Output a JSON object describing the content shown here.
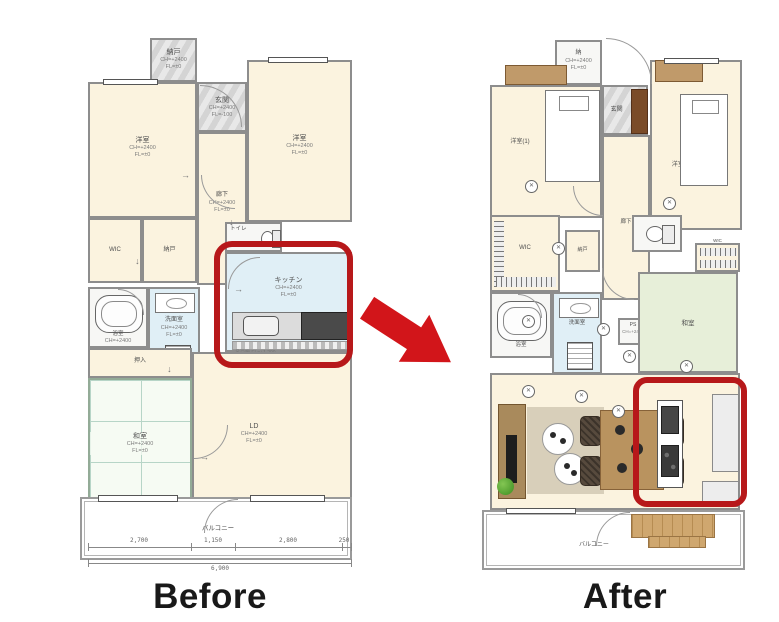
{
  "captions": {
    "before": "Before",
    "after": "After"
  },
  "icons": {
    "lamp_cross": "✕",
    "door_arrow": "→"
  },
  "colors": {
    "highlight_red": "#b7181a",
    "arrow_red": "#d2151a",
    "wall_gray": "#8d8d8d",
    "room_cream": "#fbf3df",
    "water_blue": "#e0eff6",
    "tatami_green": "#e7efd9",
    "wood_tan": "#b9935f",
    "closet_brown": "#7a4b28"
  },
  "before": {
    "rooms": {
      "storage_top": {
        "name": "納戸",
        "ch": "CH=+2400",
        "fl": "FL=±0"
      },
      "entrance": {
        "name": "玄関",
        "ch": "CH=+2400",
        "fl": "FL=-100"
      },
      "bedroom_left": {
        "name": "洋室",
        "ch": "CH=+2400",
        "fl": "FL=±0"
      },
      "bedroom_right": {
        "name": "洋室",
        "ch": "CH=+2400",
        "fl": "FL=±0"
      },
      "corridor": {
        "name": "廊下",
        "ch": "CH=+2400",
        "fl": "FL=±0"
      },
      "wic": {
        "name": "WIC"
      },
      "storage2": {
        "name": "納戸"
      },
      "bathroom": {
        "name": "浴室",
        "ch": "CH=+2400",
        "fl": "FL=±0"
      },
      "washroom": {
        "name": "洗面室",
        "ch": "CH=+2400",
        "fl": "FL=±0"
      },
      "toilet": {
        "name": "トイレ"
      },
      "kitchen": {
        "name": "キッチン",
        "ch": "CH=+2400",
        "fl": "FL=±0",
        "note": "吊戸棚 FL=+1,200"
      },
      "closet": {
        "name": "押入"
      },
      "washitsu": {
        "name": "和室",
        "ch": "CH=+2400",
        "fl": "FL=±0"
      },
      "living": {
        "name": "LD",
        "ch": "CH=+2400",
        "fl": "FL=±0"
      },
      "balcony": {
        "name": "バルコニー"
      }
    },
    "dimensions": {
      "segments": [
        "2,700",
        "1,150",
        "2,800",
        "250"
      ],
      "total": "6,900"
    }
  },
  "after": {
    "rooms": {
      "storage_top": {
        "name": "納",
        "ch": "CH=+2400",
        "fl": "FL=±0"
      },
      "entrance": {
        "name": "玄関"
      },
      "bedroom1": {
        "name": "洋室(1)"
      },
      "bedroom2": {
        "name": "洋室(2)"
      },
      "corridor": {
        "name": "廊下"
      },
      "wic_left": {
        "name": "WIC"
      },
      "storage_small": {
        "name": "納戸"
      },
      "bathroom": {
        "name": "浴室"
      },
      "washroom": {
        "name": "洗面室"
      },
      "ps": {
        "name": "PS",
        "ch": "CH=+2400",
        "fl": "FL=±0"
      },
      "washitsu": {
        "name": "和室"
      },
      "wic_right": {
        "name": "WIC"
      },
      "balcony": {
        "name": "バルコニー"
      }
    }
  }
}
